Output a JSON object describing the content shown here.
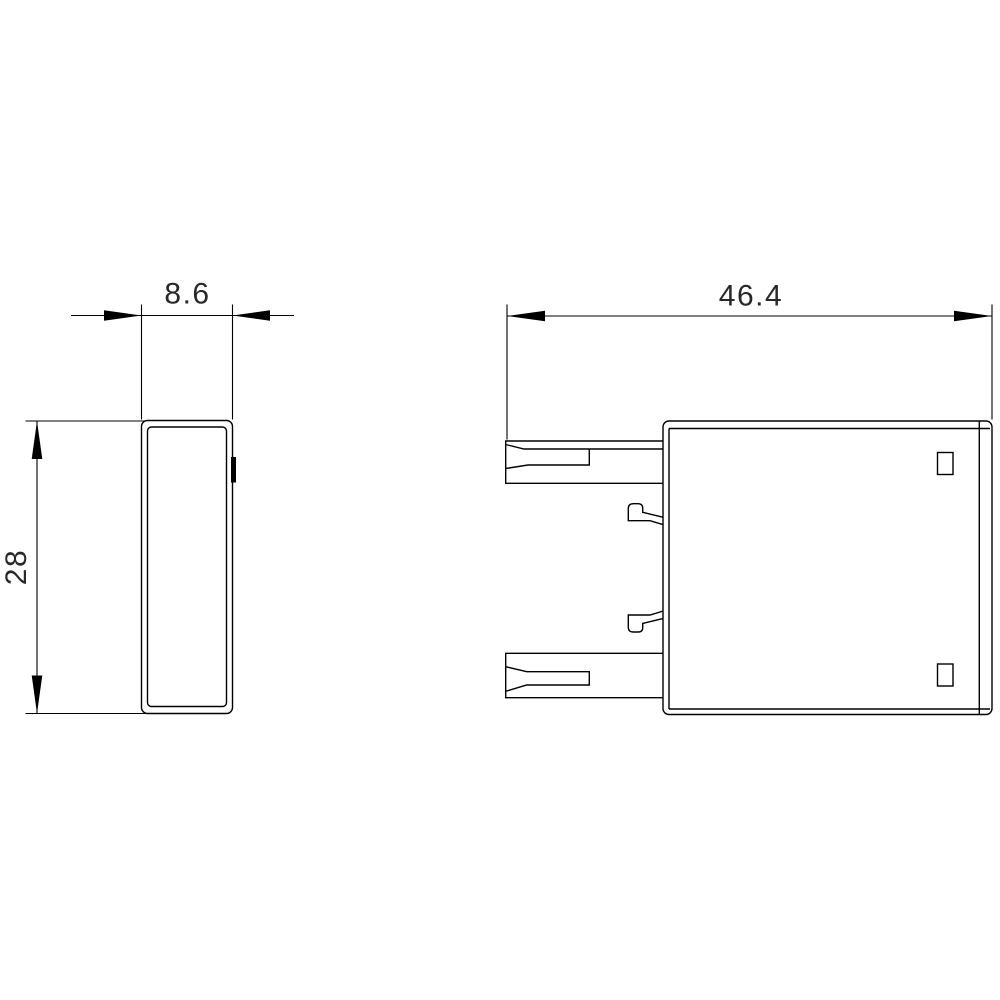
{
  "drawing": {
    "background": "#ffffff",
    "line_color": "#000000",
    "text_color": "#282828",
    "dimensions": {
      "side_width": "8.6",
      "front_width": "46.4",
      "height": "28"
    }
  }
}
